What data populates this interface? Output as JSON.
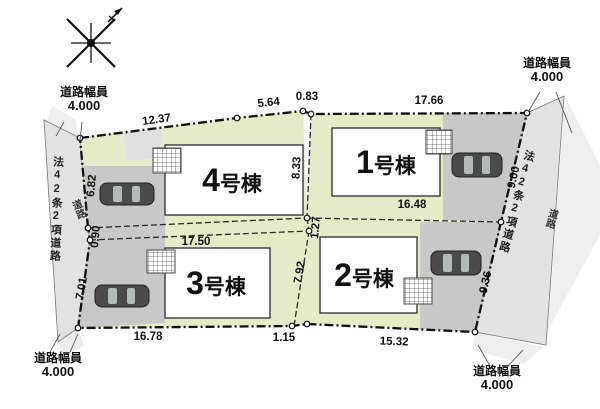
{
  "plan_type": "site-plan",
  "colors": {
    "lot_green": "#e4ebc6",
    "paving_gray": "#c8c8c8",
    "road_gray": "#e2e2e2",
    "road_light": "#eeeeee",
    "building_white": "#ffffff",
    "pad_gray": "#dfdfdf"
  },
  "icons": {
    "compass": "north-arrow",
    "car": "car-top-view",
    "entrance": "hatched-porch"
  },
  "roads": {
    "left_name": "法42条2項道路",
    "left_name_sub": "道路",
    "right_name": "法42条2項道路",
    "right_name_sub": "道路",
    "width_markers": [
      {
        "position": "top-left",
        "line1": "道路幅員",
        "line2": "4.000"
      },
      {
        "position": "top-right",
        "line1": "道路幅員",
        "line2": "4.000"
      },
      {
        "position": "bottom-left",
        "line1": "道路幅員",
        "line2": "4.000"
      },
      {
        "position": "bottom-right",
        "line1": "道路幅員",
        "line2": "4.000"
      }
    ]
  },
  "lots": [
    {
      "id": "lot-1",
      "num": "1",
      "suffix": "号棟"
    },
    {
      "id": "lot-2",
      "num": "2",
      "suffix": "号棟"
    },
    {
      "id": "lot-3",
      "num": "3",
      "suffix": "号棟"
    },
    {
      "id": "lot-4",
      "num": "4",
      "suffix": "号棟"
    }
  ],
  "dims": {
    "top": [
      "12.37",
      "5.64",
      "0.83",
      "17.66"
    ],
    "right": [
      "9.00",
      "9.36"
    ],
    "bottom": [
      "16.78",
      "1.15",
      "15.32"
    ],
    "left": [
      "6.82",
      "0.90",
      "7.01"
    ],
    "inner": [
      "8.33",
      "16.48",
      "17.50",
      "1.27",
      "7.92"
    ]
  }
}
